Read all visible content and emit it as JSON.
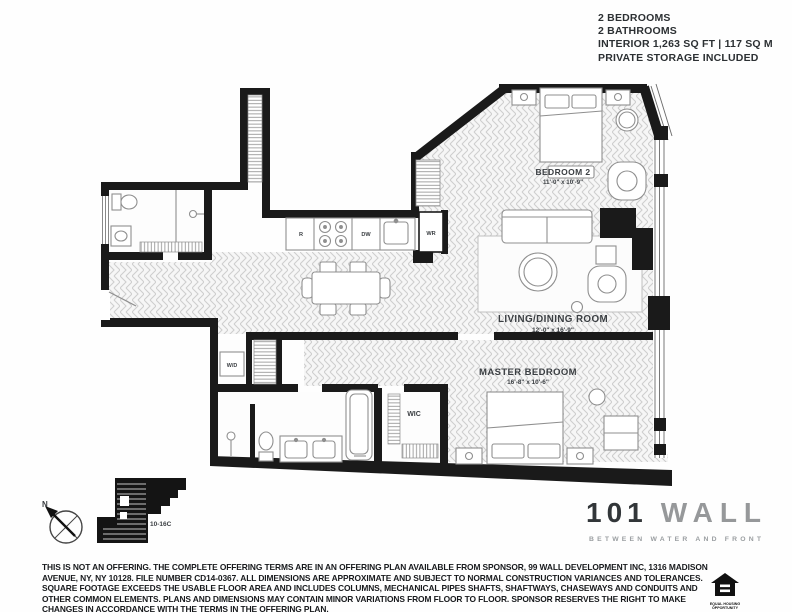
{
  "header": {
    "lines": [
      "2 BEDROOMS",
      "2 BATHROOMS",
      "INTERIOR 1,263 SQ FT  |  117 SQ M",
      "PRIVATE STORAGE INCLUDED"
    ]
  },
  "rooms": {
    "bedroom2": {
      "name": "BEDROOM 2",
      "dims": "11'-0\" x 10'-9\""
    },
    "living_dining": {
      "name": "LIVING/DINING ROOM",
      "dims": "12'-0\" x 16'-9\""
    },
    "master": {
      "name": "MASTER BEDROOM",
      "dims": "16'-8\" x 10'-6\""
    },
    "walk_in_closet": {
      "label": "WIC"
    },
    "washer_dryer": {
      "label": "W/D"
    },
    "kitchen": {
      "refrigerator_label": "R",
      "dishwasher_label": "DW",
      "wardrobe_label": "WR"
    }
  },
  "keyplan": {
    "unit_label": "10-16C",
    "north_label": "N"
  },
  "logo": {
    "number": "101",
    "name": "WALL",
    "tagline": "BETWEEN WATER AND FRONT"
  },
  "equal_housing": {
    "line1": "EQUAL HOUSING",
    "line2": "OPPORTUNITY"
  },
  "footer": {
    "disclaimer": "THIS IS NOT AN OFFERING. THE COMPLETE OFFERING TERMS ARE IN AN OFFERING PLAN AVAILABLE FROM SPONSOR, 99 WALL DEVELOPMENT INC, 1316 MADISON AVENUE, NY, NY 10128. FILE NUMBER CD14-0367. ALL DIMENSIONS ARE APPROXIMATE AND SUBJECT TO NORMAL CONSTRUCTION VARIANCES AND TOLERANCES. SQUARE FOOTAGE EXCEEDS THE USABLE FLOOR AREA AND INCLUDES COLUMNS, MECHANICAL PIPES SHAFTS, SHAFTWAYS, CHASEWAYS AND CONDUITS AND OTHER COMMON ELEMENTS. PLANS AND DIMENSIONS MAY CONTAIN MINOR VARIATIONS FROM FLOOR TO FLOOR. SPONSOR RESERVES THE RIGHT TO MAKE CHANGES IN ACCORDANCE WITH THE TERMS IN THE OFFERING PLAN."
  },
  "colors": {
    "wall": "#1a1a1a",
    "floor_hatch": "#cfcfcf",
    "text": "#2c3033",
    "logo_gray": "#96989a"
  }
}
